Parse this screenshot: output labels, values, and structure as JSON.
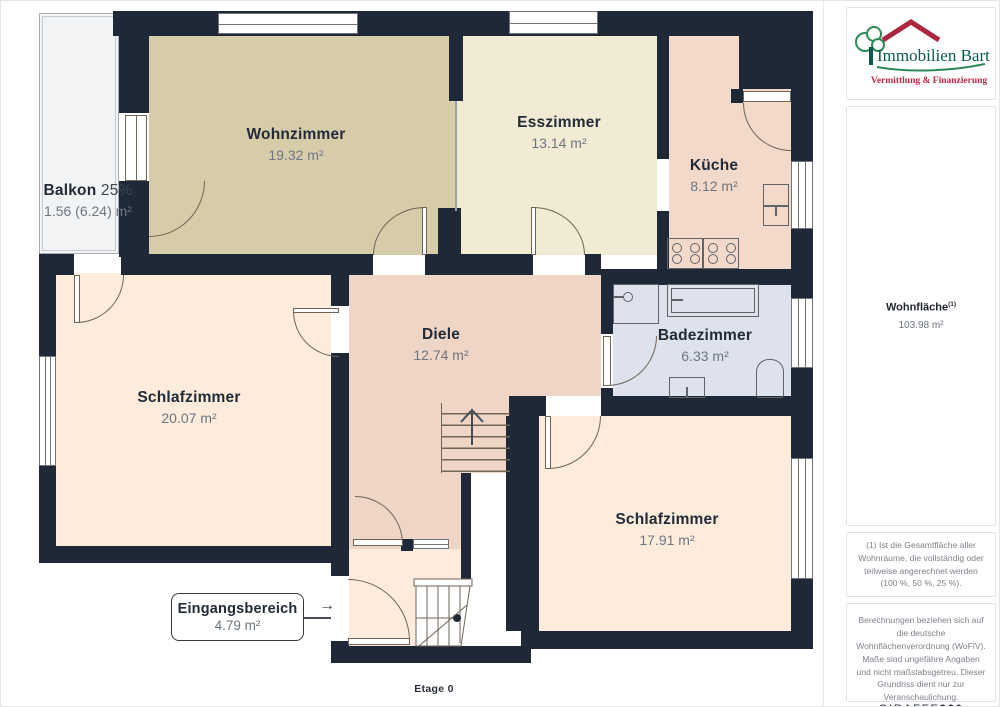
{
  "meta": {
    "floor_label": "Etage 0"
  },
  "branding": {
    "company": "Immobilien Bart",
    "tagline": "Vermittlung & Finanzierung",
    "provider": "GIRAFFE",
    "provider_suffix": "360"
  },
  "summary": {
    "label": "Wohnfläche",
    "sup": "(1)",
    "value": "103.98 m²"
  },
  "notes": {
    "note1": "(1) Ist die Gesamtfläche aller Wohnräume, die vollständig oder teilweise angerechnet werden (100 %, 50 %, 25 %).",
    "note2": "Berechnungen beziehen sich auf die deutsche Wohnflächenverordnung (WoFlV). Maße sind ungefähre Angaben und nicht maßstabsgetreu. Dieser Grundriss dient nur zur Veranschaulichung."
  },
  "rooms": [
    {
      "id": "wohnzimmer",
      "name": "Wohnzimmer",
      "area": "19.32 m²",
      "color": "#d7cca9"
    },
    {
      "id": "esszimmer",
      "name": "Esszimmer",
      "area": "13.14 m²",
      "color": "#f2ebd4"
    },
    {
      "id": "kueche",
      "name": "Küche",
      "area": "8.12 m²",
      "color": "#f3d9ca"
    },
    {
      "id": "diele",
      "name": "Diele",
      "area": "12.74 m²",
      "color": "#eed5c5"
    },
    {
      "id": "badezimmer",
      "name": "Badezimmer",
      "area": "6.33 m²",
      "color": "#dde2ec"
    },
    {
      "id": "schlafzimmer-1",
      "name": "Schlafzimmer",
      "area": "20.07 m²",
      "color": "#fdecdc"
    },
    {
      "id": "schlafzimmer-2",
      "name": "Schlafzimmer",
      "area": "17.91 m²",
      "color": "#fdecdc"
    },
    {
      "id": "balkon",
      "name": "Balkon",
      "share": "25%",
      "area": "1.56 (6.24) m²",
      "color": "#f2f3f5"
    },
    {
      "id": "eingangsbereich",
      "name": "Eingangsbereich",
      "area": "4.79 m²",
      "color": "#fdecdc"
    }
  ],
  "palette": {
    "wall": "#1e2836",
    "room_name_text": "#222b38",
    "area_text": "#6e7681"
  }
}
